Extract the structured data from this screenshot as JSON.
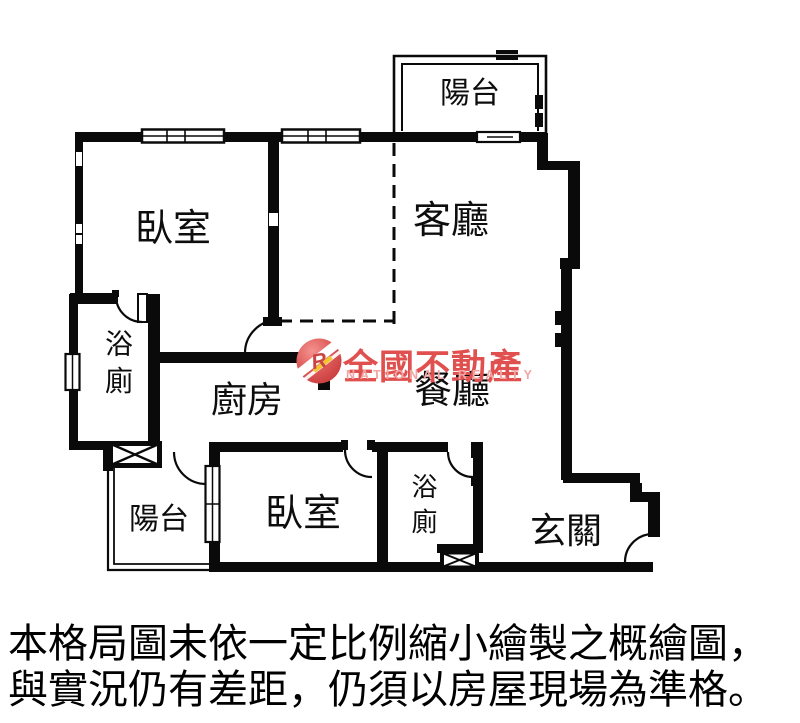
{
  "floorplan": {
    "rooms": [
      {
        "id": "balcony-top",
        "label": "陽台"
      },
      {
        "id": "bedroom-main",
        "label": "臥室"
      },
      {
        "id": "living-room",
        "label": "客廳"
      },
      {
        "id": "bathroom-main",
        "label": "浴廁"
      },
      {
        "id": "kitchen",
        "label": "廚房"
      },
      {
        "id": "dining-room",
        "label": "餐廳"
      },
      {
        "id": "balcony-lower",
        "label": "陽台"
      },
      {
        "id": "bedroom-second",
        "label": "臥室"
      },
      {
        "id": "bathroom-second",
        "label": "浴廁"
      },
      {
        "id": "entry",
        "label": "玄關"
      }
    ],
    "line_color": "#0a0a0a"
  },
  "watermark": {
    "brand_cn": "全國不動產",
    "brand_en": "NATIONAL REALTY",
    "logo_letter": "R",
    "brand_red": "#e0504e",
    "brand_pink": "#f0a6a5",
    "logo_red": "#d6494b",
    "logo_yellow": "#f3c431"
  },
  "caption": {
    "line1": "本格局圖未依一定比例縮小繪製之概繪圖，",
    "line2": "與實況仍有差距，仍須以房屋現場為準格。"
  }
}
